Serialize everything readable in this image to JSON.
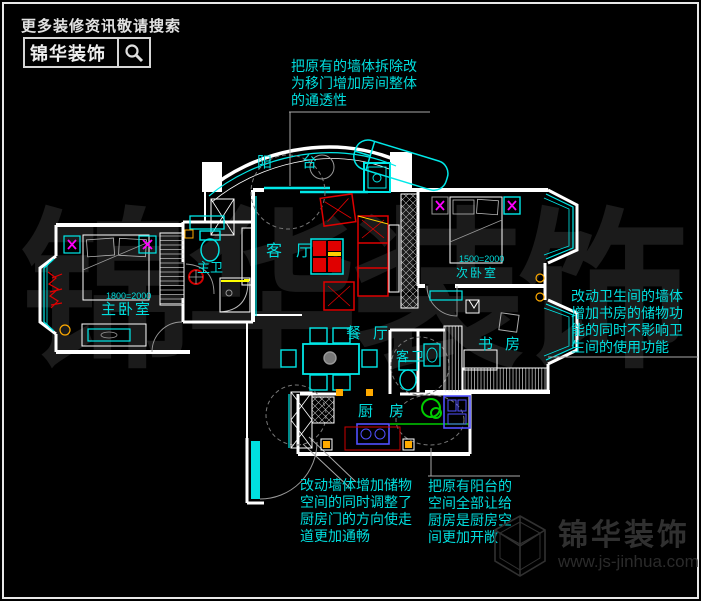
{
  "header": {
    "tagline": "更多装修资讯敬请搜索",
    "brand": "锦华装饰"
  },
  "watermark": {
    "text": "锦华装饰"
  },
  "footer": {
    "brand": "锦华装饰",
    "website": "www.js-jinhua.com"
  },
  "plan": {
    "rooms": {
      "balcony": "阳台",
      "living": "客厅",
      "dining": "餐厅",
      "master_bedroom": "主卧室",
      "master_bed_size": "1800=2000",
      "master_bath": "主卫",
      "second_bedroom": "次卧室",
      "second_bed_size": "1500=2000",
      "study": "书房",
      "guest_bath": "客卫",
      "kitchen": "厨房"
    },
    "colors": {
      "wall": "#ffffff",
      "window_fixture": "#00e8e8",
      "furniture": "#e00000",
      "decor": "#ff00ff",
      "appliance": "#5050ff",
      "plant": "#00cc00",
      "highlight": "#ffff00",
      "label": "#00dede",
      "leader": "#9a9a9a",
      "watermark": "#1b1b1b"
    }
  },
  "annotations": {
    "top": {
      "lines": [
        "把原有的墙体拆除改",
        "为移门增加房间整体",
        "的通透性"
      ]
    },
    "right": {
      "lines": [
        "改动卫生间的墙体",
        "增加书房的储物功",
        "能的同时不影响卫",
        "生间的使用功能"
      ]
    },
    "bottom_left": {
      "lines": [
        "改动墙体增加储物",
        "空间的同时调整了",
        "厨房门的方向使走",
        "道更加通畅"
      ]
    },
    "bottom_middle": {
      "lines": [
        "把原有阳台的",
        "空间全部让给",
        "厨房是厨房空",
        "间更加开敞"
      ]
    }
  }
}
